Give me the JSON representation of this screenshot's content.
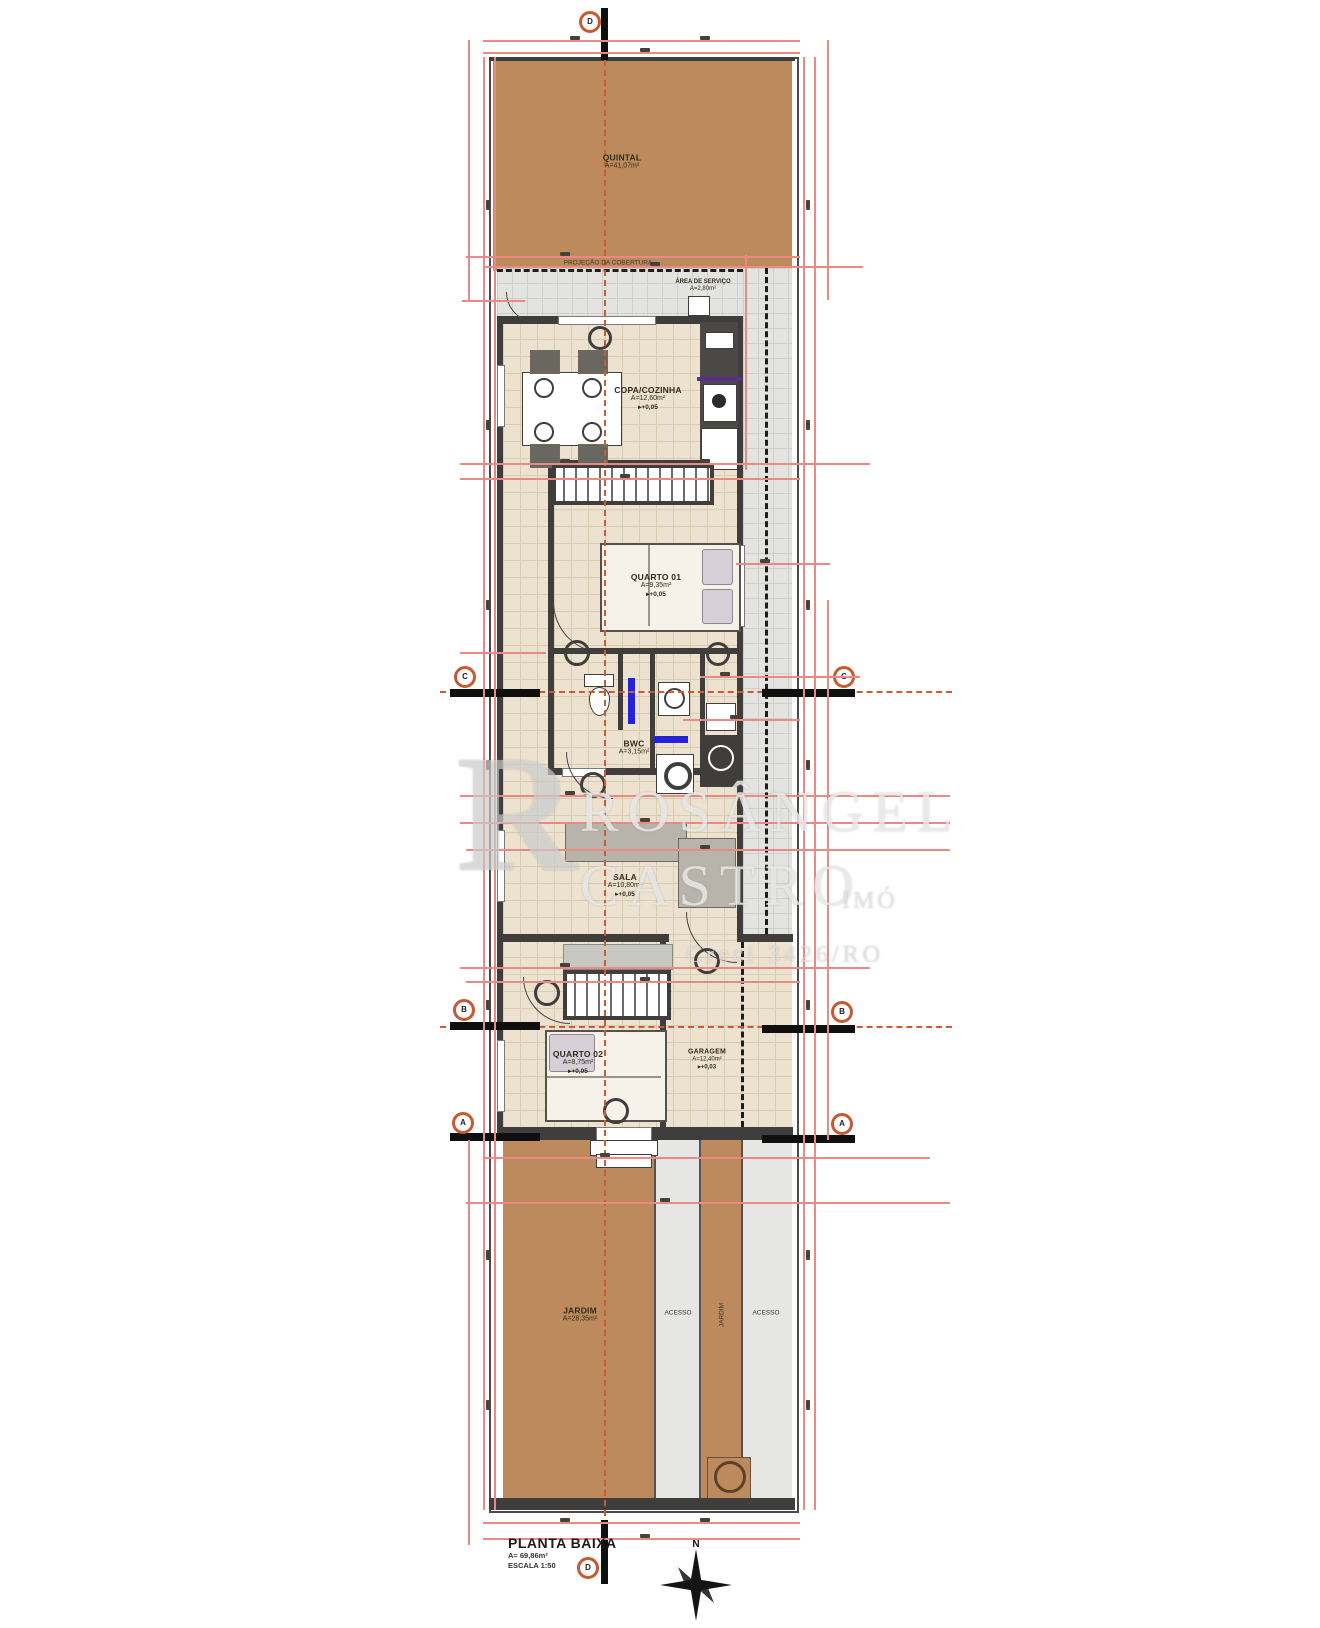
{
  "title_block": {
    "title": "PLANTA BAIXA",
    "area": "A= 69,86m²",
    "scale": "ESCALA 1:50"
  },
  "compass": {
    "north": "N"
  },
  "watermark": {
    "logo": "R",
    "line1": "ROSÂNGELA",
    "line2": "CASTRO",
    "line2b": "IMÓ",
    "line3": "Creci 3426/RO"
  },
  "rooms": {
    "quintal": {
      "name": "QUINTAL",
      "area": "A=41,07m²"
    },
    "servico": {
      "name": "ÁREA DE SERVIÇO",
      "area": "A=2,80m²"
    },
    "cozinha": {
      "name": "COPA/COZINHA",
      "area": "A=12,60m²",
      "level": "+0,05"
    },
    "quarto1": {
      "name": "QUARTO 01",
      "area": "A=9,35m²",
      "level": "+0,05"
    },
    "banheiro": {
      "name": "BWC",
      "area": "A=3,15m²",
      "level": "+0,03"
    },
    "sala": {
      "name": "SALA",
      "area": "A=10,80m²",
      "level": "+0,05"
    },
    "quarto2": {
      "name": "QUARTO 02",
      "area": "A=8,75m²",
      "level": "+0,05"
    },
    "garagem": {
      "name": "GARAGEM",
      "area": "A=12,40m²",
      "level": "+0,03"
    },
    "jardim": {
      "name": "JARDIM",
      "area": "A=28,35m²"
    },
    "faixa_esq": {
      "name": "ACESSO"
    },
    "faixa_centro": {
      "name": "JARDIM"
    },
    "faixa_dir": {
      "name": "ACESSO"
    }
  },
  "annotations": {
    "projecao": "PROJEÇÃO DA COBERTURA"
  },
  "markers": {
    "top": "D",
    "bottom": "D",
    "c": "C",
    "b": "B",
    "a": "A"
  },
  "colors": {
    "wall": "#3f3e3c",
    "yard_brown": "#bd8a5e",
    "floor_beige": "#ece2cf",
    "paving_gray": "#e3e3e0",
    "dimension_red": "#ea8a84",
    "axis_orange": "#cc5a35",
    "plumbing_blue": "#2424d6",
    "counter_purple": "#5b2d8e"
  }
}
